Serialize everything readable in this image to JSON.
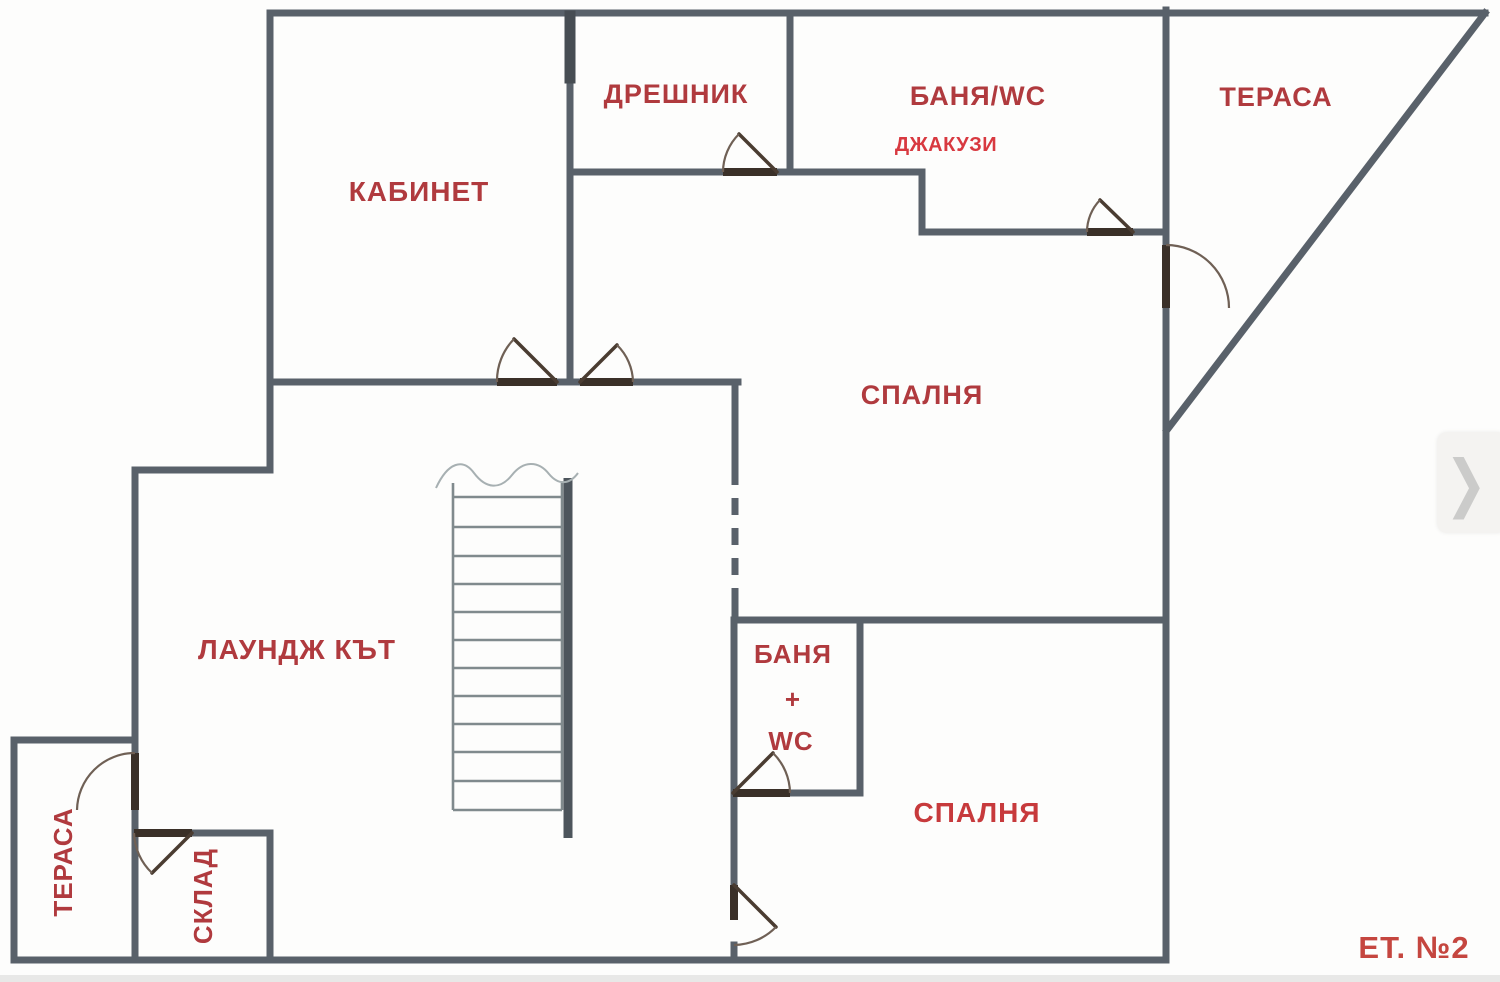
{
  "floor_plan": {
    "labels": {
      "kabinet": "КАБИНЕТ",
      "dreshnik": "ДРЕШНИК",
      "banya_wc": "БАНЯ/WC",
      "jacuzzi": "ДЖАКУЗИ",
      "terrace_top": "ТЕРАСА",
      "bedroom_upper": "СПАЛНЯ",
      "lounge": "ЛАУНДЖ КЪТ",
      "banya_plus_wc": {
        "line1": "БАНЯ",
        "line2": "+",
        "line3": "WC"
      },
      "bedroom_lower": "СПАЛНЯ",
      "terrace_left": "ТЕРАСА",
      "storage": "СКЛАД",
      "floor_number": "ЕТ. №2"
    },
    "colors": {
      "wall": "#59616a",
      "label_red": "#b03a3e",
      "jacuzzi_red": "#d83940",
      "floor_label_red": "#c5463f",
      "door_dark": "#3a3028",
      "stair_gray": "#808a8d"
    }
  },
  "overlay": {
    "next_button_icon": "❯"
  }
}
